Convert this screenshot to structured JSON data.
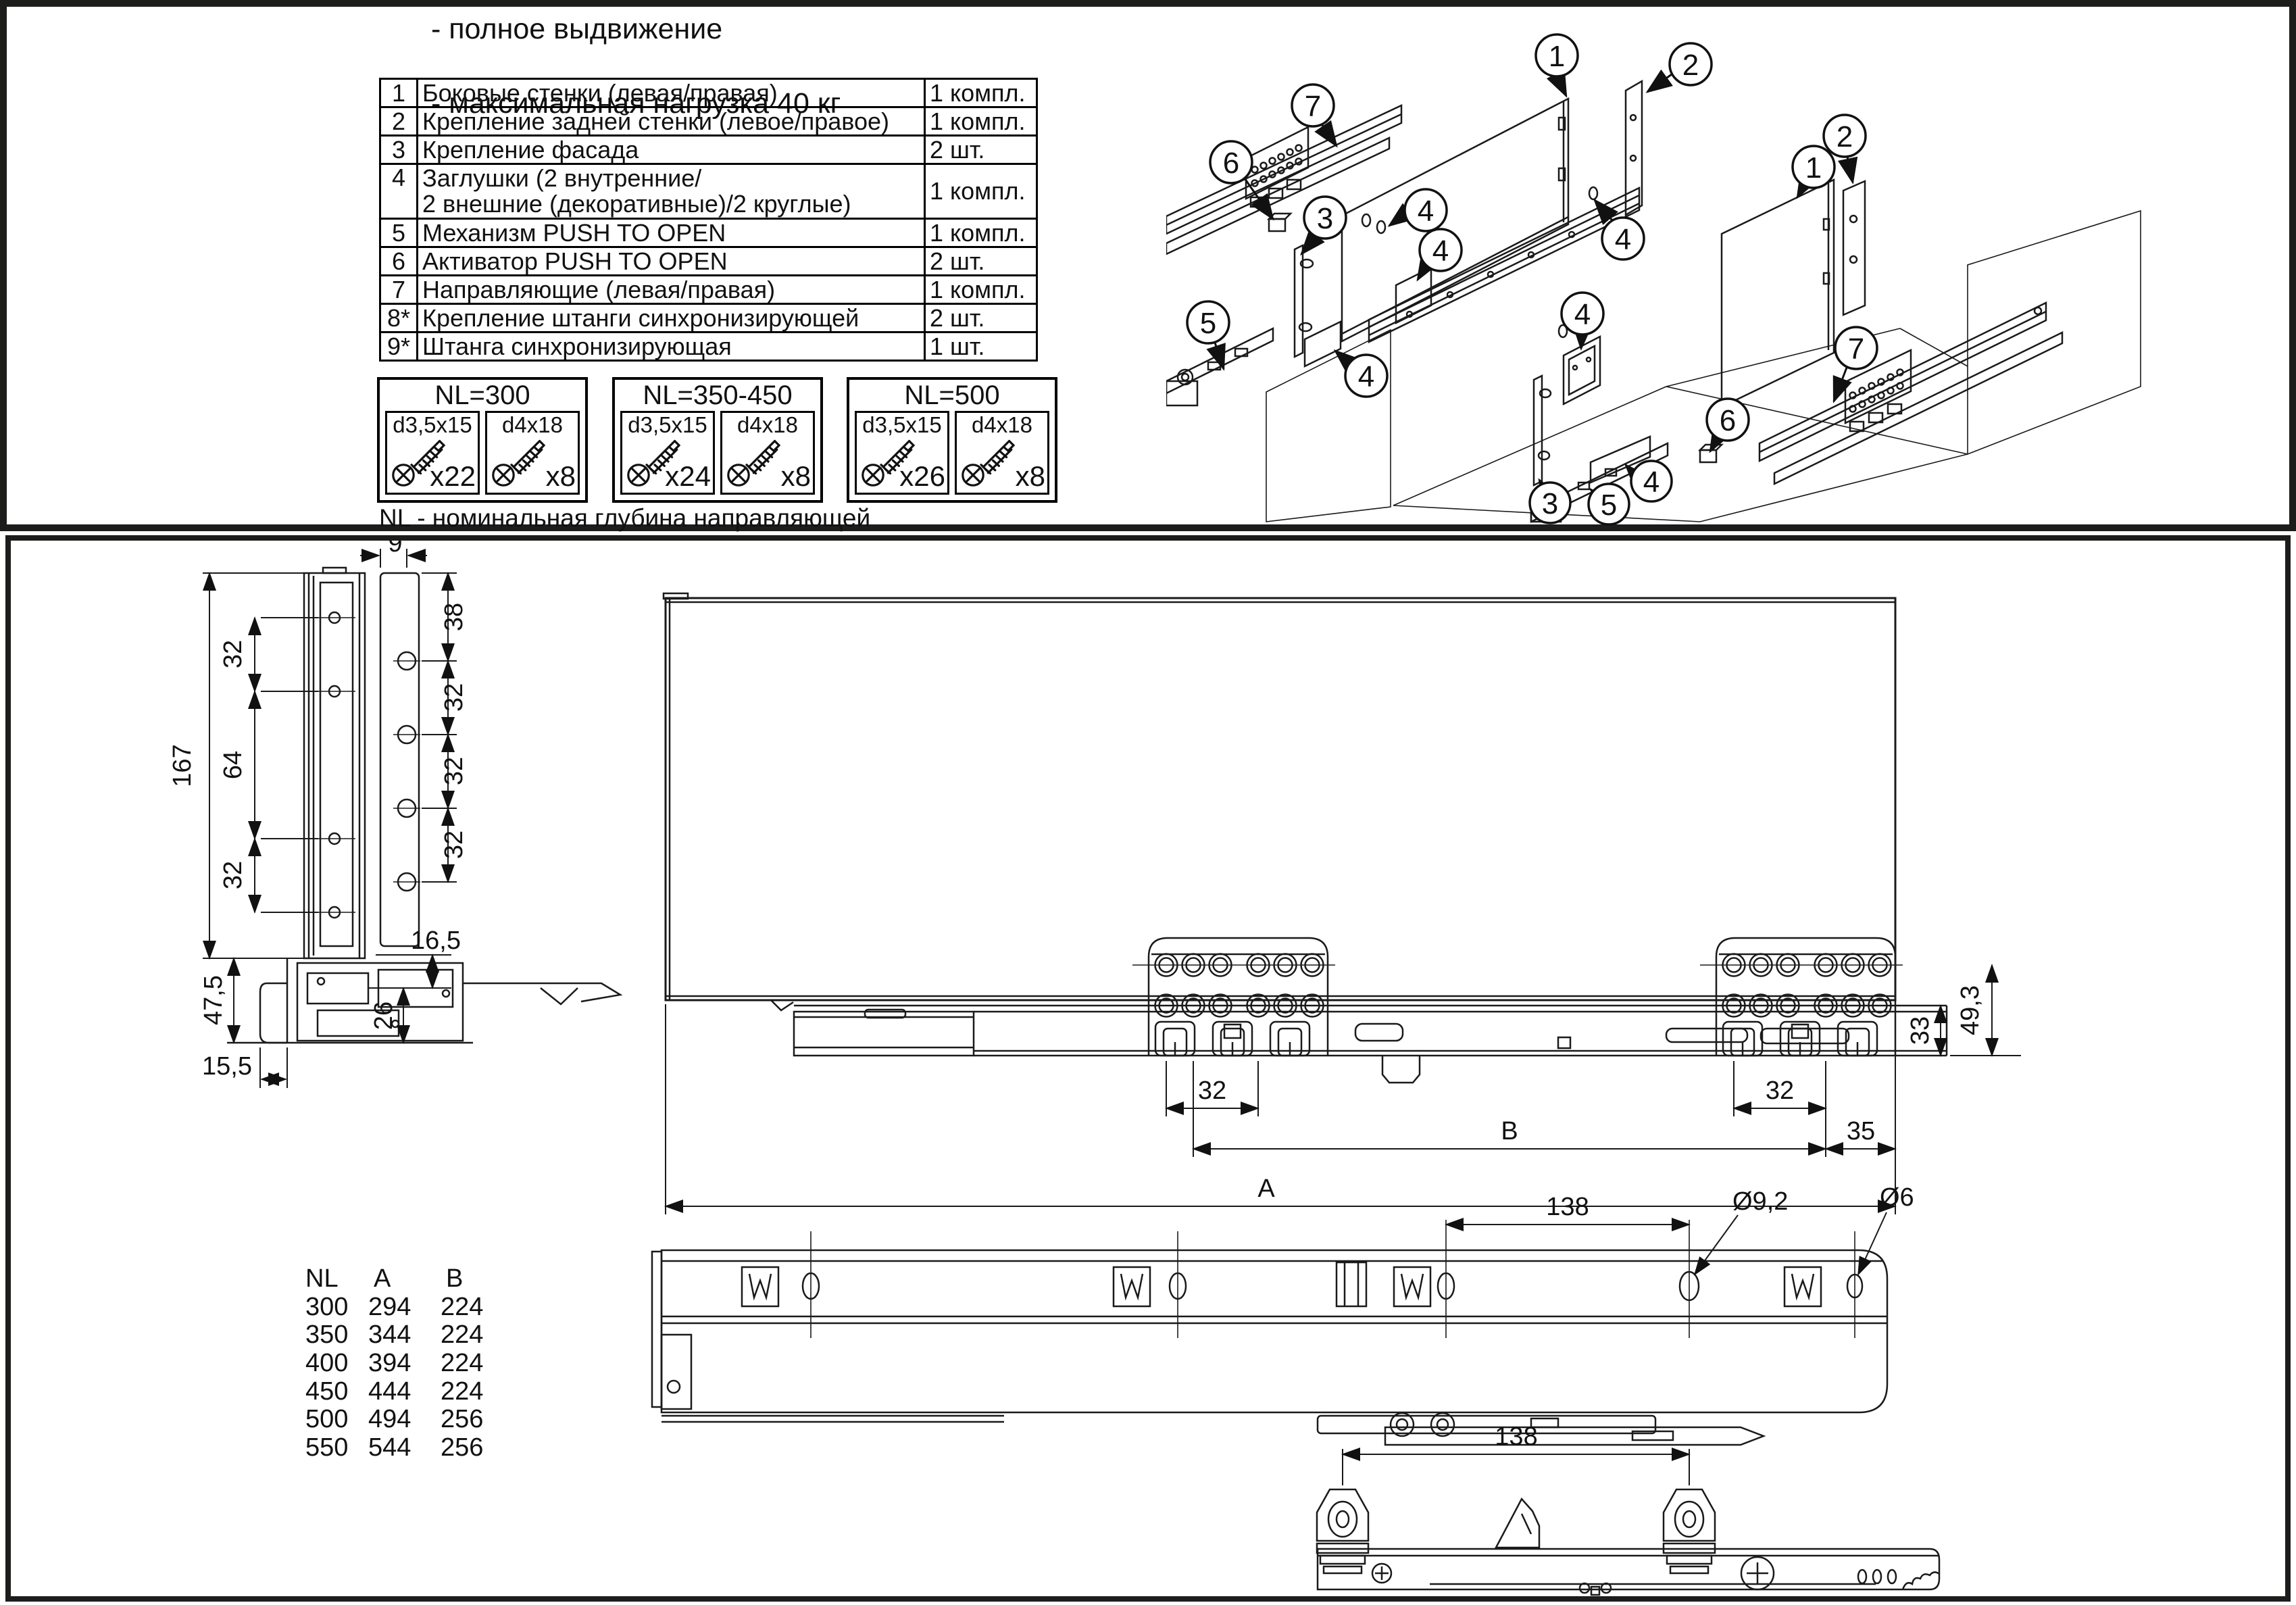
{
  "top": {
    "notes": [
      "- полное выдвижение",
      "- максимальная нагрузка 40 кг"
    ],
    "parts": [
      {
        "num": "1",
        "name": "Боковые стенки (левая/правая)",
        "qty": "1 компл."
      },
      {
        "num": "2",
        "name": "Крепление задней стенки (левое/правое)",
        "qty": "1 компл."
      },
      {
        "num": "3",
        "name": "Крепление фасада",
        "qty": "2 шт."
      },
      {
        "num": "4",
        "name": "Заглушки (2 внутренние/\n2 внешние (декоративные)/2 круглые)",
        "qty": "1 компл."
      },
      {
        "num": "5",
        "name": "Механизм PUSH TO OPEN",
        "qty": "1 компл."
      },
      {
        "num": "6",
        "name": "Активатор PUSH TO OPEN",
        "qty": "2 шт."
      },
      {
        "num": "7",
        "name": "Направляющие (левая/правая)",
        "qty": "1 компл."
      },
      {
        "num": "8*",
        "name": "Крепление штанги синхронизирующей",
        "qty": "2 шт."
      },
      {
        "num": "9*",
        "name": "Штанга синхронизирующая",
        "qty": "1 шт."
      }
    ],
    "screw_kits": [
      {
        "title": "NL=300",
        "screws": [
          {
            "size": "d3,5x15",
            "count": "x22"
          },
          {
            "size": "d4x18",
            "count": "x8"
          }
        ]
      },
      {
        "title": "NL=350-450",
        "screws": [
          {
            "size": "d3,5x15",
            "count": "x24"
          },
          {
            "size": "d4x18",
            "count": "x8"
          }
        ]
      },
      {
        "title": "NL=500",
        "screws": [
          {
            "size": "d3,5x15",
            "count": "x26"
          },
          {
            "size": "d4x18",
            "count": "x8"
          }
        ]
      }
    ],
    "nl_note": "NL - номинальная глубина направляющей"
  },
  "callouts": {
    "c1": "1",
    "c2": "2",
    "c3": "3",
    "c4": "4",
    "c5": "5",
    "c6": "6",
    "c7": "7"
  },
  "dims": {
    "d9": "9",
    "d38": "38",
    "d32": "32",
    "d64": "64",
    "d167": "167",
    "d16_5": "16,5",
    "d26": "26",
    "d47_5": "47,5",
    "d15_5": "15,5",
    "d33": "33",
    "d49_3": "49,3",
    "d35": "35",
    "dA": "A",
    "dB": "B",
    "d138": "138",
    "dia9_2": "Ø9,2",
    "dia6": "Ø6"
  },
  "size_table": {
    "headers": [
      "NL",
      "A",
      "B"
    ],
    "rows": [
      [
        "300",
        "294",
        "224"
      ],
      [
        "350",
        "344",
        "224"
      ],
      [
        "400",
        "394",
        "224"
      ],
      [
        "450",
        "444",
        "224"
      ],
      [
        "500",
        "494",
        "256"
      ],
      [
        "550",
        "544",
        "256"
      ]
    ]
  }
}
